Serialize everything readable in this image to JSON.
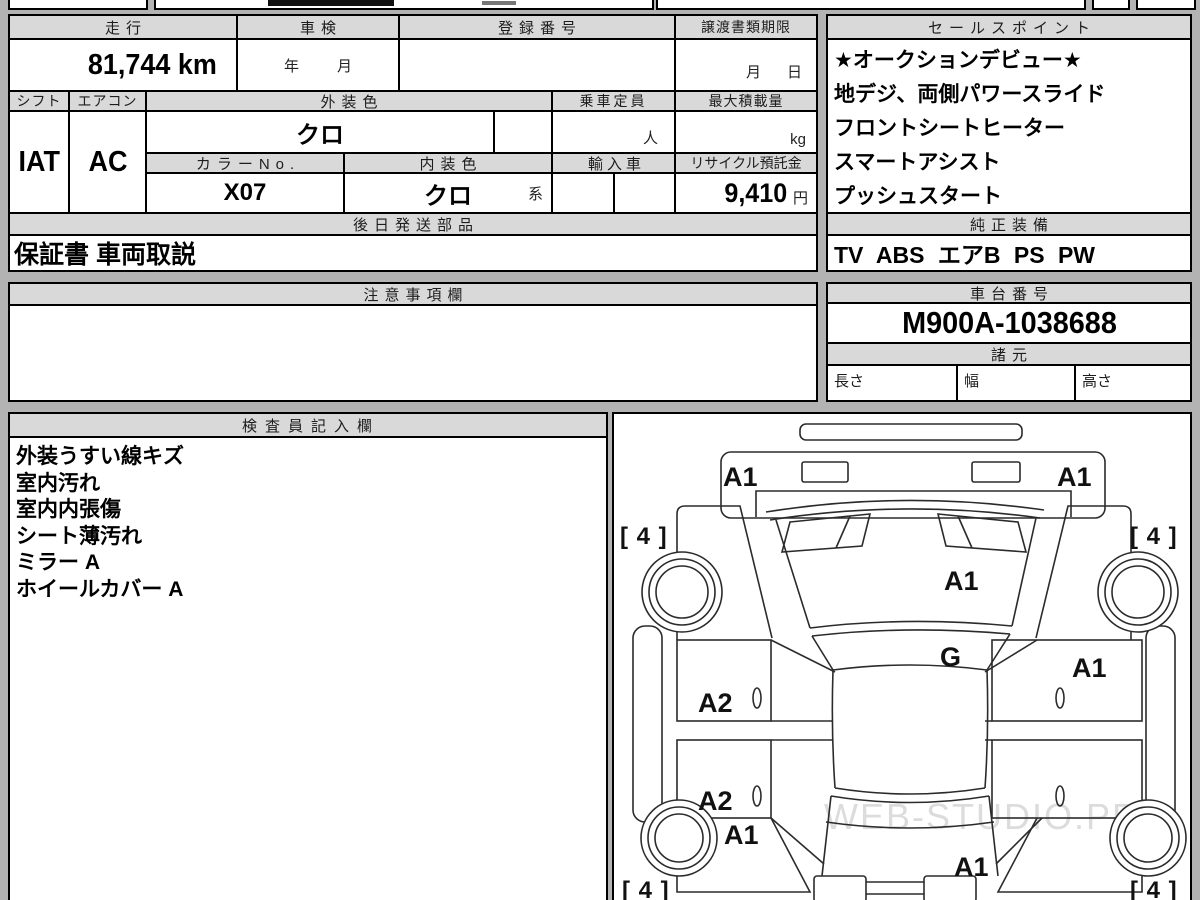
{
  "vehicle_table": {
    "mileage": {
      "header": "走行",
      "value": "81,744 km"
    },
    "inspection": {
      "header": "車検",
      "year_label": "年",
      "month_label": "月"
    },
    "registration": {
      "header": "登録番号",
      "value": ""
    },
    "transfer_deadline": {
      "header": "譲渡書類期限",
      "month_label": "月",
      "day_label": "日"
    },
    "shift": {
      "header": "シフト",
      "value": "IAT"
    },
    "aircon": {
      "header": "エアコン",
      "value": "AC"
    },
    "exterior_color": {
      "header": "外装色",
      "value": "クロ"
    },
    "capacity": {
      "header": "乗車定員",
      "value": "",
      "unit": "人"
    },
    "max_load": {
      "header": "最大積載量",
      "value": "",
      "unit": "kg"
    },
    "color_no": {
      "header": "カラーNo.",
      "value": "X07"
    },
    "interior_color": {
      "header": "内装色",
      "value": "クロ",
      "suffix": "系"
    },
    "import_car": {
      "header": "輸入車",
      "value": ""
    },
    "recycle_fee": {
      "header": "リサイクル預託金",
      "value": "9,410",
      "unit": "円"
    },
    "later_shipped_parts": {
      "header": "後日発送部品",
      "value": "保証書 車両取説"
    }
  },
  "sales_points": {
    "header": "セールスポイント",
    "lines": [
      "★オークションデビュー★",
      "地デジ、両側パワースライド",
      "フロントシートヒーター",
      "スマートアシスト",
      "プッシュスタート"
    ]
  },
  "genuine_equipment": {
    "header": "純正装備",
    "value": "TV ABS エアB PS PW"
  },
  "notes": {
    "header": "注意事項欄",
    "value": ""
  },
  "chassis": {
    "header": "車台番号",
    "value": "M900A-1038688"
  },
  "specs": {
    "header": "諸元",
    "length_label": "長さ",
    "width_label": "幅",
    "height_label": "高さ",
    "length_value": "",
    "width_value": "",
    "height_value": ""
  },
  "inspector": {
    "header": "検査員記入欄",
    "lines": [
      "外装うすい線キズ",
      "室内汚れ",
      "室内内張傷",
      "シート薄汚れ",
      "ミラー A",
      "ホイールカバー A"
    ]
  },
  "diagram": {
    "marks": {
      "front_bumper_left": "A1",
      "front_bumper_right": "A1",
      "front_tire_left": "[ 4 ]",
      "front_tire_right": "[ 4 ]",
      "windshield": "A1",
      "hood": "G",
      "front_door_right": "A1",
      "front_door_left": "A2",
      "rear_door_left": "A2",
      "rear_fender_left": "A1",
      "rear_gate": "A1",
      "rear_tire_left": "[ 4 ]",
      "rear_tire_right": "[ 4 ]"
    },
    "watermark": "WEB-STUDIO.PRO"
  }
}
